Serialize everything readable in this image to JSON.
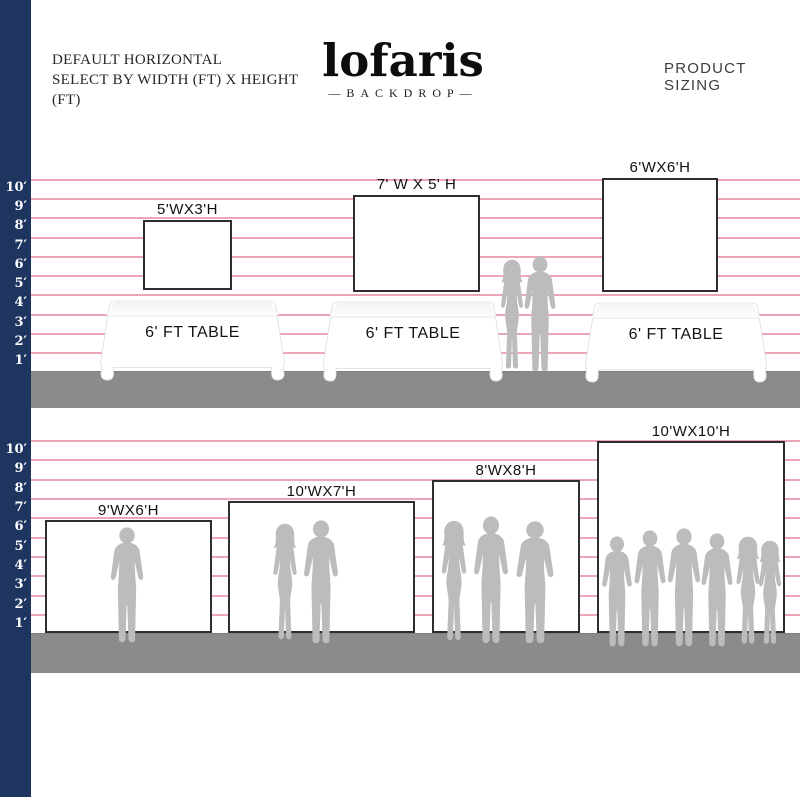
{
  "header": {
    "title_line1": "DEFAULT HORIZONTAL",
    "title_line2": "SELECT BY WIDTH (FT) X HEIGHT (FT)",
    "product_sizing": "PRODUCT SIZING"
  },
  "logo": {
    "wordmark": "lofaris",
    "subtitle": "—BACKDROP—"
  },
  "ruler_top": {
    "labels": [
      "10′",
      "9′",
      "8′",
      "7′",
      "6′",
      "5′",
      "4′",
      "3′",
      "2′",
      "1′"
    ]
  },
  "ruler_bottom": {
    "labels": [
      "10′",
      "9′",
      "8′",
      "7′",
      "6′",
      "5′",
      "4′",
      "3′",
      "2′",
      "1′"
    ]
  },
  "tabletop_section": {
    "table_label": "6' FT TABLE",
    "backdrops": [
      {
        "size_label": "5'WX3'H",
        "width_ft": 5,
        "height_ft": 3
      },
      {
        "size_label": "7' W X 5' H",
        "width_ft": 7,
        "height_ft": 5
      },
      {
        "size_label": "6'WX6'H",
        "width_ft": 6,
        "height_ft": 6
      }
    ]
  },
  "floor_section": {
    "backdrops": [
      {
        "size_label": "9'WX6'H",
        "width_ft": 9,
        "height_ft": 6,
        "people_count": 1
      },
      {
        "size_label": "10'WX7'H",
        "width_ft": 10,
        "height_ft": 7,
        "people_count": 2
      },
      {
        "size_label": "8'WX8'H",
        "width_ft": 8,
        "height_ft": 8,
        "people_count": 3
      },
      {
        "size_label": "10'WX10'H",
        "width_ft": 10,
        "height_ft": 10,
        "people_count": 6
      }
    ]
  },
  "icons": {
    "man_silhouette": "man-silhouette-icon",
    "woman_silhouette": "woman-silhouette-icon"
  },
  "colors": {
    "navy_bar": "#1e3560",
    "grid_pink": "#eda6b6",
    "floor_gray": "#8b8b8b",
    "silhouette_gray": "#bcbcbc",
    "backdrop_border": "#2e2e2e"
  }
}
